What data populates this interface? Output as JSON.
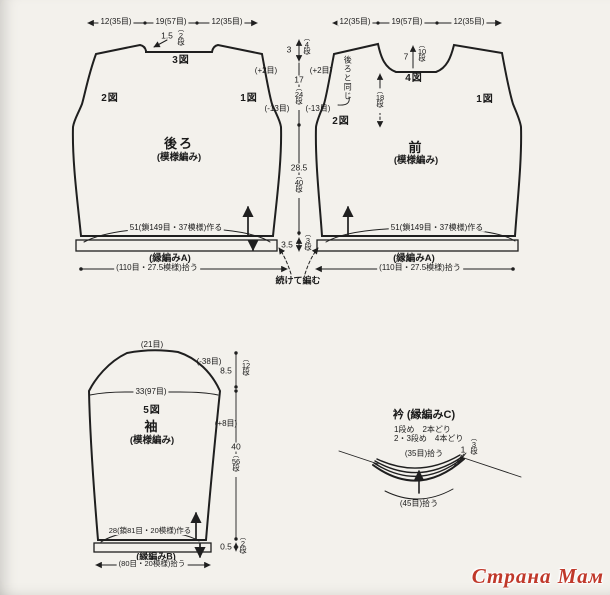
{
  "glyphs": {
    "vparen_open": "︵",
    "vparen_close": "︶",
    "dan": "段"
  },
  "watermark": {
    "text": "Страна Мам",
    "color": "#c0392b"
  },
  "back": {
    "top_measures": [
      "12(35目)",
      "19(57目)",
      "12(35目)"
    ],
    "neck_depth": "1.5",
    "neck_rows": "2",
    "fig_neck": "3図",
    "fig_left": "2図",
    "fig_right": "1図",
    "name": "後ろ",
    "stitch": "(模様編み)",
    "hem_make": "51(鎖149目・37模様)作る",
    "hem_band": "(縁編みA)",
    "hem_pickup": "(110目・27.5模様)拾う"
  },
  "front": {
    "top_measures": [
      "12(35目)",
      "19(57目)",
      "12(35目)"
    ],
    "neck_depth": "7",
    "neck_rows": "10",
    "fig_neck": "4図",
    "fig_left": "2図",
    "fig_right": "1図",
    "same_as_back": "後ろと同じ",
    "mid_rows": "18",
    "name": "前",
    "stitch": "(模様編み)",
    "hem_make": "51(鎖149目・37模様)作る",
    "hem_band": "(縁編みA)",
    "hem_pickup": "(110目・27.5模様)拾う"
  },
  "center": {
    "shoulder": "3",
    "shoulder_rows": "4",
    "plus_left": "(+2目)",
    "plus_right": "(+2目)",
    "armhole": "17",
    "armhole_rows": "24",
    "minus_left": "(-13目)",
    "minus_right": "(-13目)",
    "body": "28.5",
    "body_rows": "40",
    "hem": "3.5",
    "hem_rows": "3",
    "continue_note": "続けて編む"
  },
  "sleeve": {
    "top_sts": "(21目)",
    "cap_dec": "(-38目)",
    "cap_height": "8.5",
    "cap_rows": "12",
    "top_width": "33(97目)",
    "fig": "5図",
    "name": "袖",
    "stitch": "(模様編み)",
    "inc": "(+8目)",
    "length": "40",
    "length_rows": "56",
    "cuff_make": "28(鎖81目・20模様)作る",
    "cuff_band": "(縁編みB)",
    "cuff_height": "0.5",
    "cuff_rows": "2",
    "cuff_pickup": "(80目・20模様)拾う"
  },
  "collar": {
    "title": "衿 (縁編みC)",
    "note_row1": "1段め　2本どり",
    "note_row23": "2・3段め　4本どり",
    "pickup_top": "(35目)拾う",
    "height": "1",
    "height_rows": "3",
    "pickup_bottom": "(45目)拾う"
  }
}
